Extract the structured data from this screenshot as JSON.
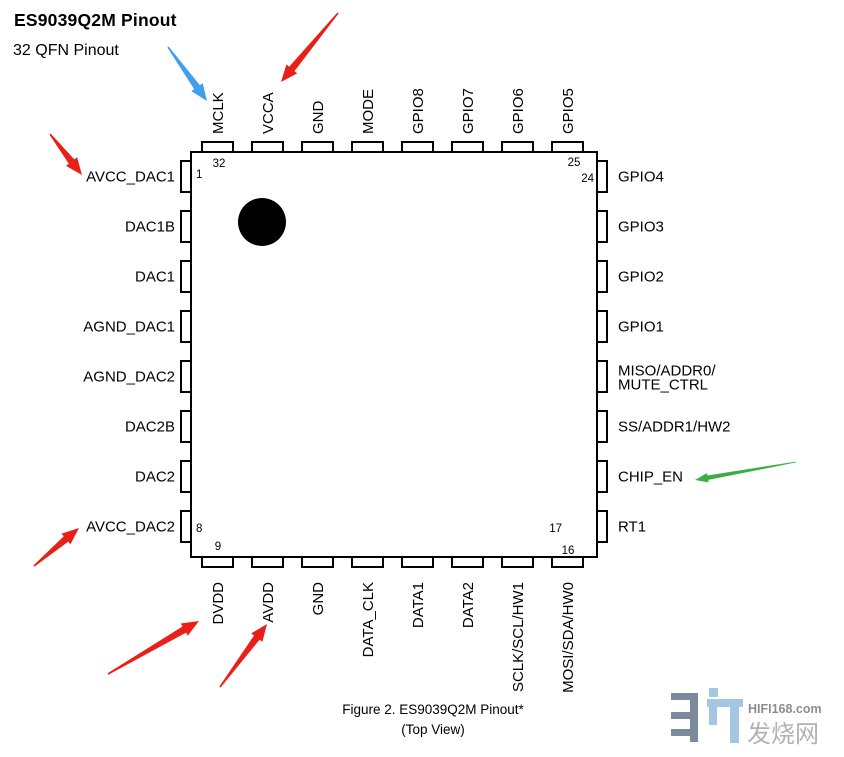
{
  "header": {
    "title": "ES9039Q2M Pinout",
    "subtitle": "32 QFN Pinout"
  },
  "chip": {
    "part_name": "ES9039Q2M",
    "package": "32 QFN",
    "pin1_marker": "filled-dot",
    "top_pins": [
      "MCLK",
      "VCCA",
      "GND",
      "MODE",
      "GPIO8",
      "GPIO7",
      "GPIO6",
      "GPIO5"
    ],
    "left_pins": [
      "AVCC_DAC1",
      "DAC1B",
      "DAC1",
      "AGND_DAC1",
      "AGND_DAC2",
      "DAC2B",
      "DAC2",
      "AVCC_DAC2"
    ],
    "right_pins": [
      "GPIO4",
      "GPIO3",
      "GPIO2",
      "GPIO1",
      "MISO/ADDR0/\nMUTE_CTRL",
      "SS/ADDR1/HW2",
      "CHIP_EN",
      "RT1"
    ],
    "bottom_pins": [
      "DVDD",
      "AVDD",
      "GND",
      "DATA_CLK",
      "DATA1",
      "DATA2",
      "SCLK/SCL/HW1",
      "MOSI/SDA/HW0"
    ],
    "corner_pin_numbers": {
      "pin32": "32",
      "pin1": "1",
      "pin25": "25",
      "pin24": "24",
      "pin8": "8",
      "pin9": "9",
      "pin17": "17",
      "pin16": "16"
    }
  },
  "annotations": [
    {
      "name": "blue-arrow-mclk",
      "color": "arrow_blue",
      "style": "bold",
      "target": "MCLK",
      "tail": [
        168,
        47
      ],
      "tip": [
        207,
        101
      ]
    },
    {
      "name": "red-arrow-vcca",
      "color": "arrow_red",
      "style": "bold",
      "target": "VCCA",
      "tail": [
        338,
        13
      ],
      "tip": [
        281,
        82
      ]
    },
    {
      "name": "red-arrow-avcc-dac1",
      "color": "arrow_red",
      "style": "bold",
      "target": "AVCC_DAC1",
      "tail": [
        50,
        134
      ],
      "tip": [
        82,
        175
      ]
    },
    {
      "name": "red-arrow-avcc-dac2",
      "color": "arrow_red",
      "style": "bold",
      "target": "AVCC_DAC2",
      "tail": [
        34,
        566
      ],
      "tip": [
        79,
        528
      ]
    },
    {
      "name": "red-arrow-dvdd",
      "color": "arrow_red",
      "style": "bold",
      "target": "DVDD",
      "tail": [
        108,
        674
      ],
      "tip": [
        199,
        621
      ]
    },
    {
      "name": "red-arrow-avdd",
      "color": "arrow_red",
      "style": "bold",
      "target": "AVDD",
      "tail": [
        220,
        687
      ],
      "tip": [
        267,
        624
      ]
    },
    {
      "name": "green-arrow-chip-en",
      "color": "arrow_green",
      "style": "slim",
      "target": "CHIP_EN",
      "tail": [
        796,
        462
      ],
      "tip": [
        695,
        480
      ]
    }
  ],
  "caption": {
    "line1": "Figure 2. ES9039Q2M Pinout*",
    "line2": "(Top View)"
  },
  "watermark": {
    "site": "HIFI168.com",
    "name": "发烧网"
  },
  "colors": {
    "ink": "#000000",
    "arrow_red": "#ea1f18",
    "arrow_blue": "#3f9fec",
    "arrow_green": "#3cad44",
    "watermark_dark": "#7c8aa0",
    "watermark_light": "#a5c6e3",
    "watermark_text": "#8d8d8d",
    "watermark_cjk": "#b2b2b2"
  }
}
